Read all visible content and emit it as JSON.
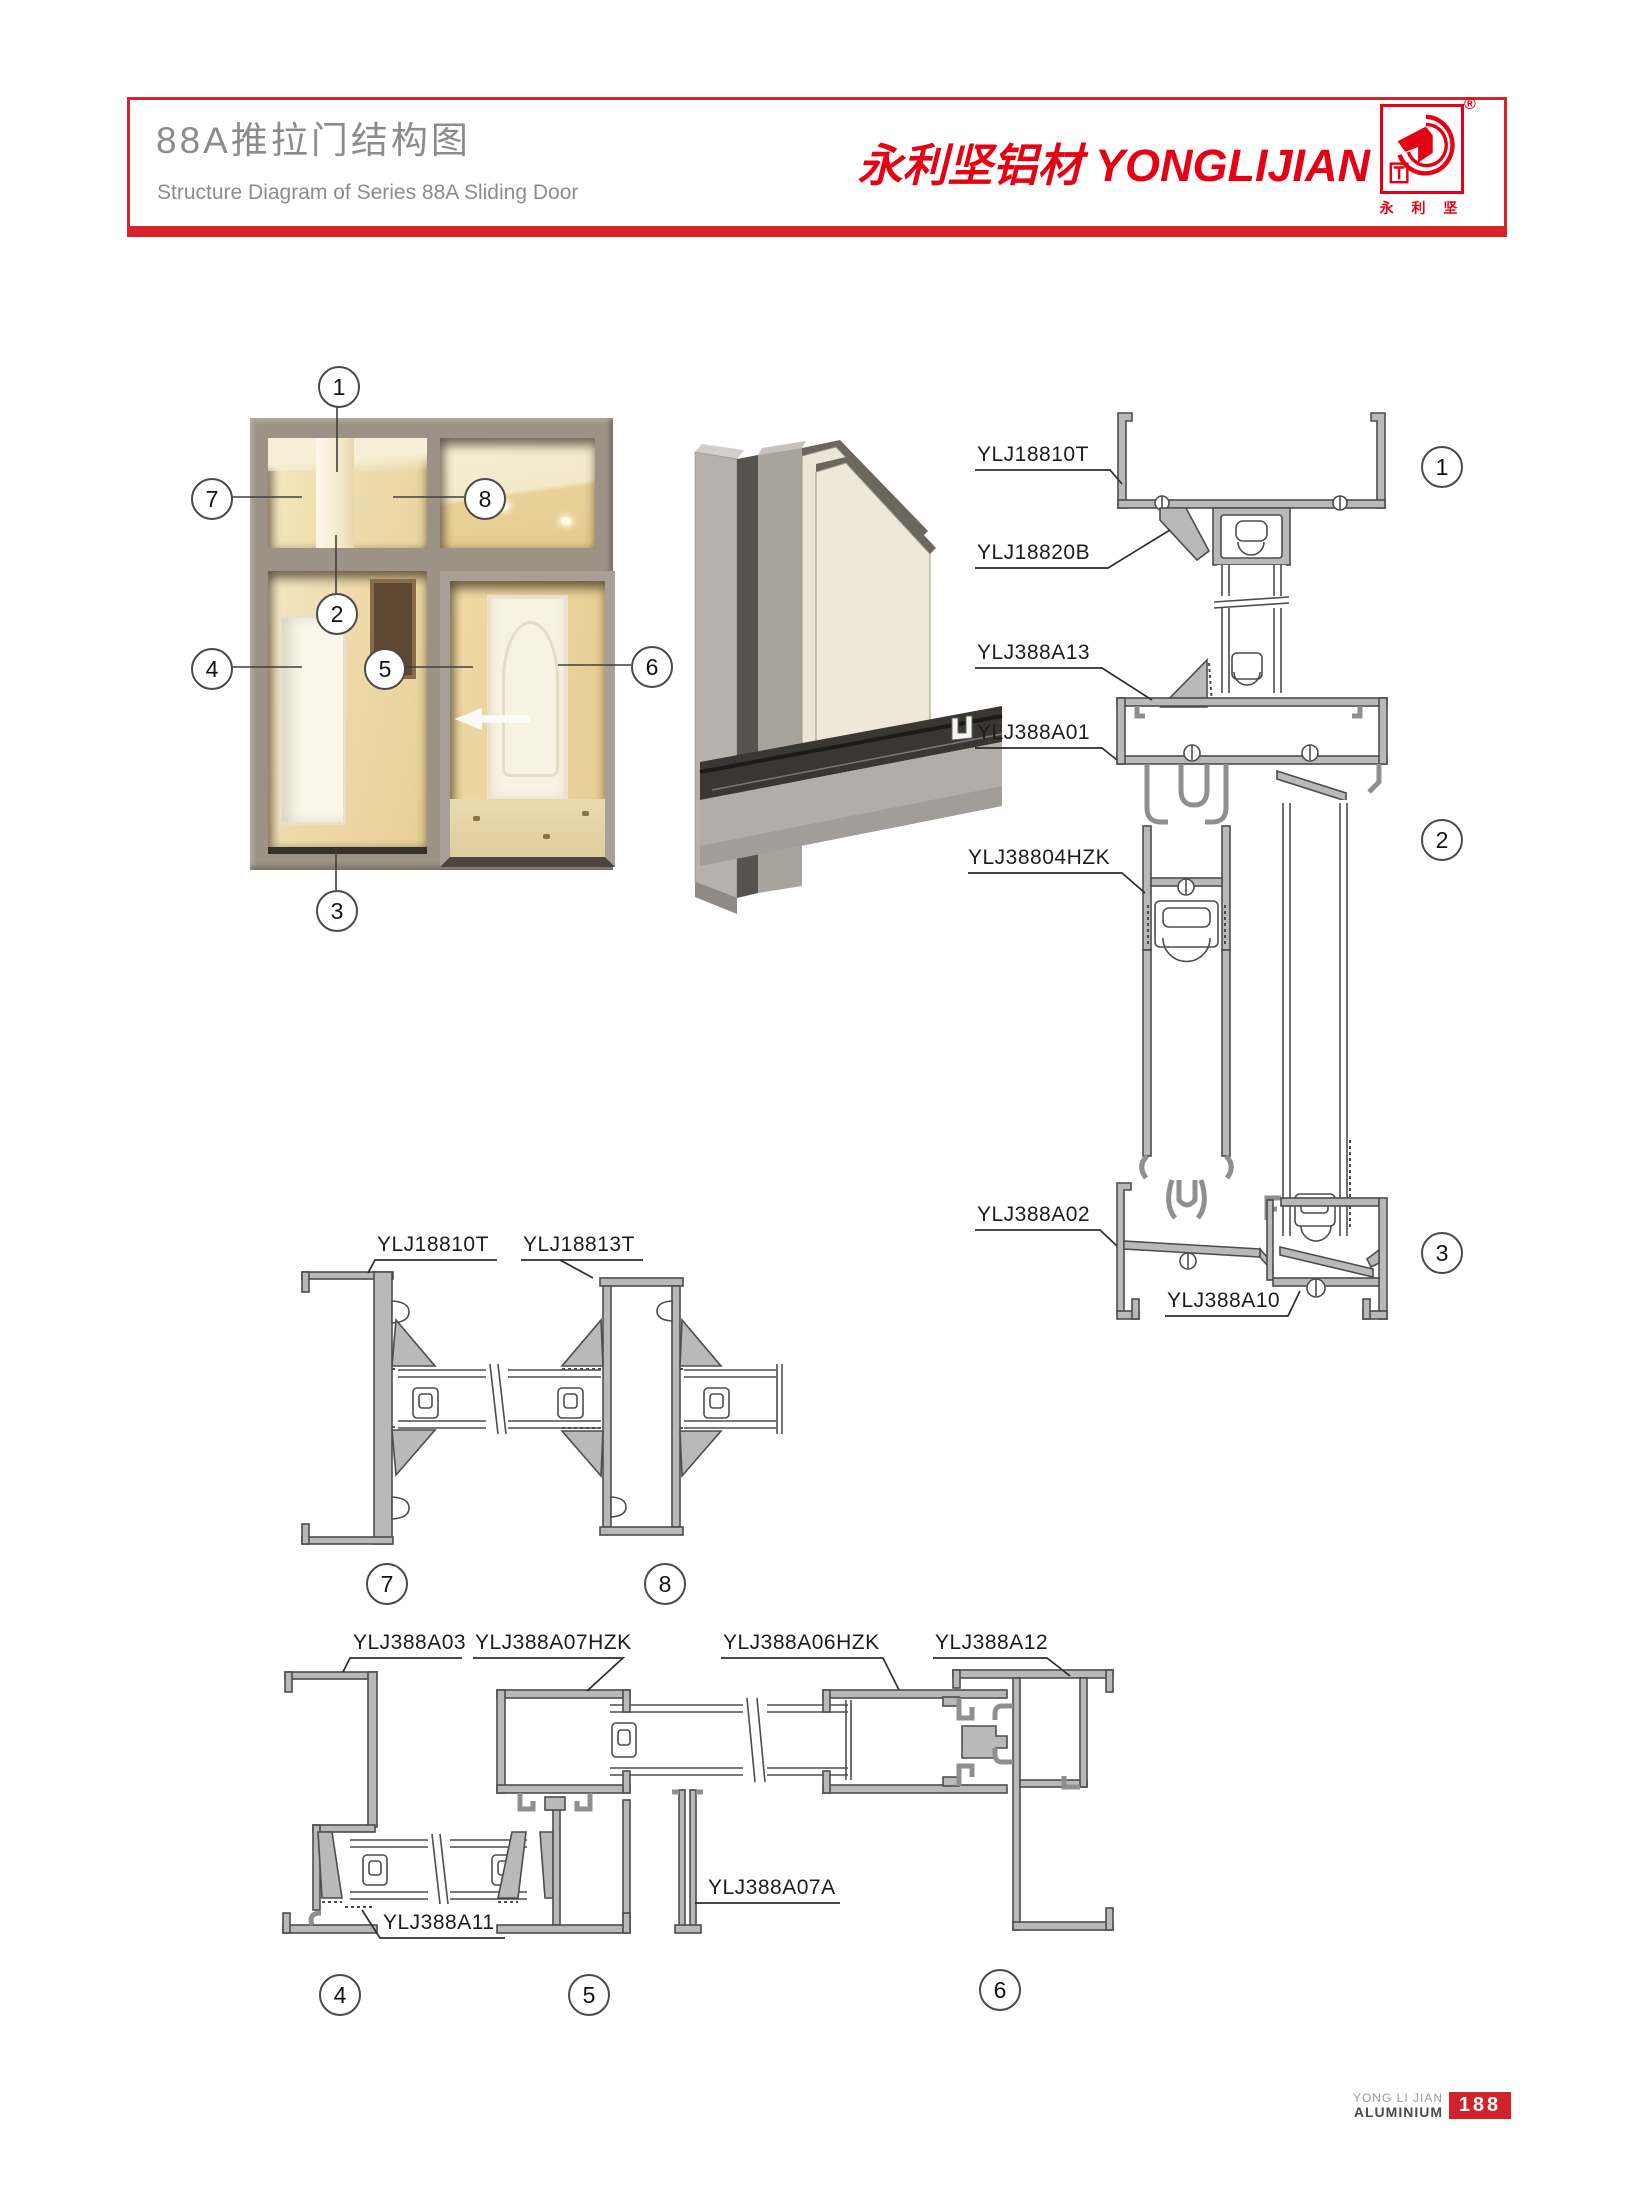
{
  "page": {
    "title_zh": "88A推拉门结构图",
    "title_en": "Structure Diagram of Series 88A Sliding Door",
    "brand": {
      "zh": "永利坚铝材",
      "en": "YONGLIJIAN",
      "registered": "®",
      "logo_chars": "永 利 坚"
    },
    "footer": {
      "line1": "YONG LI JIAN",
      "line2": "ALUMINIUM",
      "page_number": "188"
    },
    "accent_color": "#d8232a",
    "brand_color": "#e60013"
  },
  "diagram": {
    "window_callouts": [
      {
        "num": "1",
        "x": 337,
        "y": 385
      },
      {
        "num": "2",
        "x": 335,
        "y": 612
      },
      {
        "num": "3",
        "x": 335,
        "y": 909
      },
      {
        "num": "4",
        "x": 210,
        "y": 667
      },
      {
        "num": "5",
        "x": 383,
        "y": 667
      },
      {
        "num": "6",
        "x": 650,
        "y": 665
      },
      {
        "num": "7",
        "x": 210,
        "y": 497
      },
      {
        "num": "8",
        "x": 483,
        "y": 497
      }
    ],
    "section_callouts": [
      {
        "num": "1",
        "x": 1440,
        "y": 465
      },
      {
        "num": "2",
        "x": 1440,
        "y": 838
      },
      {
        "num": "3",
        "x": 1440,
        "y": 1251
      },
      {
        "num": "7",
        "x": 385,
        "y": 1582
      },
      {
        "num": "8",
        "x": 663,
        "y": 1582
      },
      {
        "num": "4",
        "x": 338,
        "y": 1993
      },
      {
        "num": "5",
        "x": 587,
        "y": 1993
      },
      {
        "num": "6",
        "x": 998,
        "y": 1988
      }
    ],
    "part_labels": [
      {
        "text": "YLJ18810T",
        "x": 977,
        "y": 443
      },
      {
        "text": "YLJ18820B",
        "x": 977,
        "y": 541
      },
      {
        "text": "YLJ388A13",
        "x": 977,
        "y": 641
      },
      {
        "text": "YLJ388A01",
        "x": 977,
        "y": 721
      },
      {
        "text": "YLJ38804HZK",
        "x": 968,
        "y": 846
      },
      {
        "text": "YLJ388A02",
        "x": 977,
        "y": 1203
      },
      {
        "text": "YLJ388A10",
        "x": 1167,
        "y": 1289
      },
      {
        "text": "YLJ18810T",
        "x": 377,
        "y": 1233
      },
      {
        "text": "YLJ18813T",
        "x": 523,
        "y": 1233
      },
      {
        "text": "YLJ388A03",
        "x": 353,
        "y": 1631
      },
      {
        "text": "YLJ388A07HZK",
        "x": 475,
        "y": 1631
      },
      {
        "text": "YLJ388A06HZK",
        "x": 723,
        "y": 1631
      },
      {
        "text": "YLJ388A12",
        "x": 935,
        "y": 1631
      },
      {
        "text": "YLJ388A11",
        "x": 383,
        "y": 1911
      },
      {
        "text": "YLJ388A07A",
        "x": 708,
        "y": 1876
      }
    ]
  }
}
